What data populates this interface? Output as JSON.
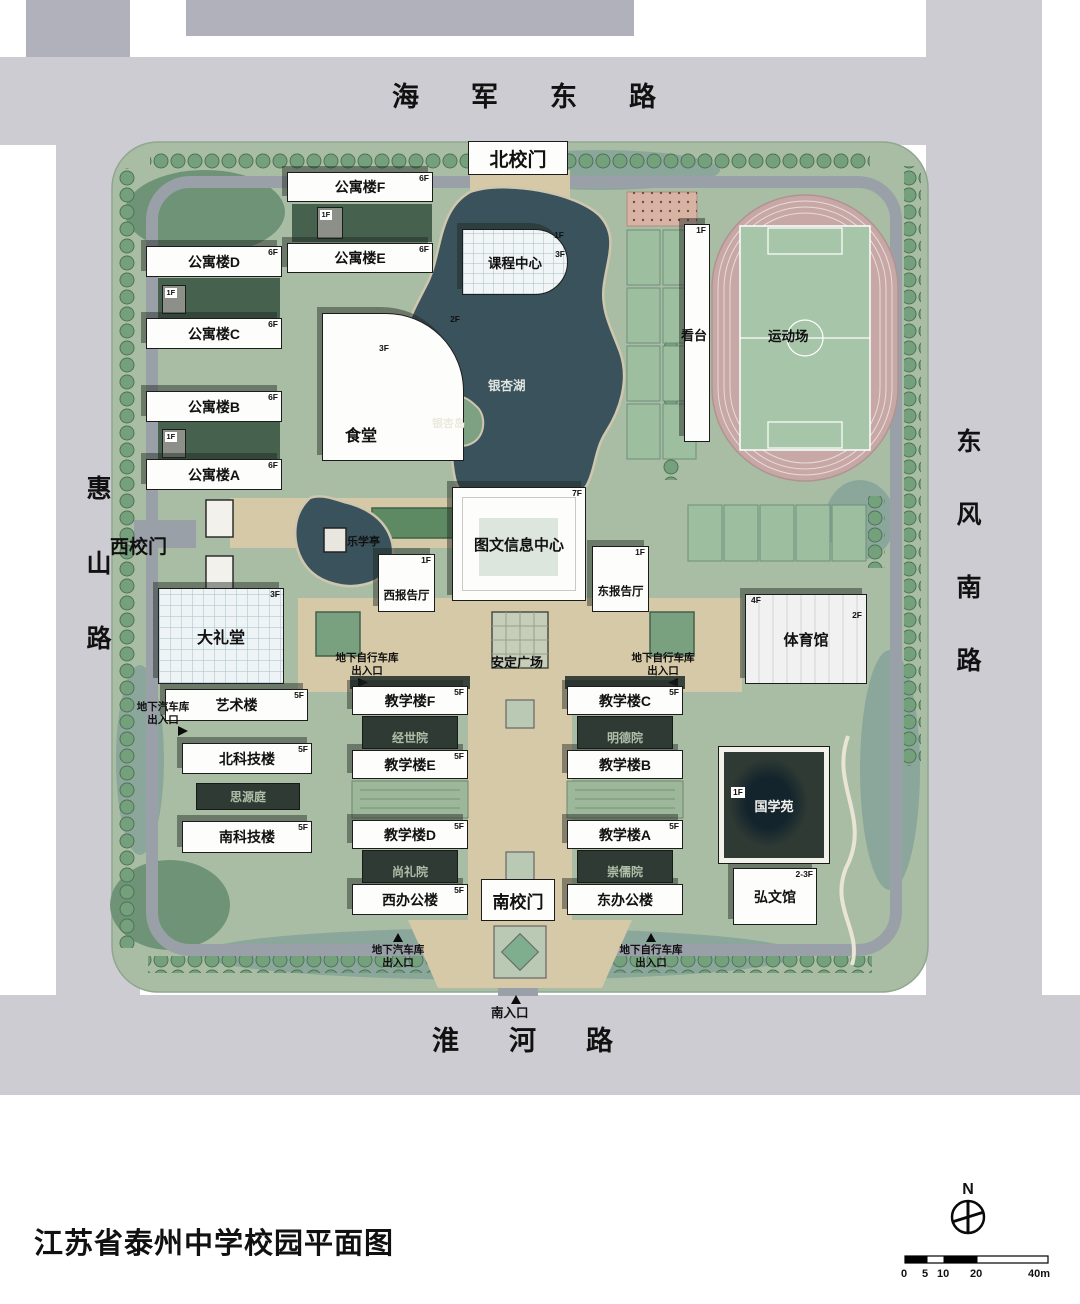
{
  "title": "江苏省泰州中学校园平面图",
  "roads": {
    "north": "海军东路",
    "west": "惠山路",
    "east": "东风南路",
    "south": "淮河路"
  },
  "gates": {
    "north": "北校门",
    "west": "西校门",
    "south": "南校门"
  },
  "landscape": {
    "lake": "银杏湖",
    "island": "银杏岛",
    "pavilion": "乐学亭",
    "plaza": "安定广场",
    "field": "运动场"
  },
  "underground": {
    "car": "地下汽车库",
    "bike": "地下自行车库",
    "entrance": "出入口",
    "south_entrance": "南入口"
  },
  "annex_floor": "1F",
  "buildings": [
    {
      "id": "apartment-f",
      "label": "公寓楼F",
      "floors": "6F"
    },
    {
      "id": "apartment-e",
      "label": "公寓楼E",
      "floors": "6F"
    },
    {
      "id": "apartment-d",
      "label": "公寓楼D",
      "floors": "6F"
    },
    {
      "id": "apartment-c",
      "label": "公寓楼C",
      "floors": "6F"
    },
    {
      "id": "apartment-b",
      "label": "公寓楼B",
      "floors": "6F"
    },
    {
      "id": "apartment-a",
      "label": "公寓楼A",
      "floors": "6F"
    },
    {
      "id": "canteen",
      "label": "食堂",
      "floors": "3F",
      "floors2": "2F"
    },
    {
      "id": "course-center",
      "label": "课程中心",
      "floors": "3F",
      "floors2": "1F"
    },
    {
      "id": "library",
      "label": "图文信息中心",
      "floors": "7F"
    },
    {
      "id": "west-lecture",
      "label": "西报告厅",
      "floors": "1F"
    },
    {
      "id": "east-lecture",
      "label": "东报告厅",
      "floors": "1F"
    },
    {
      "id": "auditorium",
      "label": "大礼堂",
      "floors": "3F"
    },
    {
      "id": "art",
      "label": "艺术楼",
      "floors": "5F"
    },
    {
      "id": "north-science",
      "label": "北科技楼",
      "floors": "5F"
    },
    {
      "id": "south-science",
      "label": "南科技楼",
      "floors": "5F"
    },
    {
      "id": "grandstand",
      "label": "看台",
      "floors": "1F"
    },
    {
      "id": "gym",
      "label": "体育馆",
      "floors": "4F",
      "floors2": "2F"
    },
    {
      "id": "teaching-f",
      "label": "教学楼F",
      "floors": "5F"
    },
    {
      "id": "teaching-e",
      "label": "教学楼E",
      "floors": "5F"
    },
    {
      "id": "teaching-d",
      "label": "教学楼D",
      "floors": "5F"
    },
    {
      "id": "teaching-c",
      "label": "教学楼C",
      "floors": "5F"
    },
    {
      "id": "teaching-b",
      "label": "教学楼B"
    },
    {
      "id": "teaching-a",
      "label": "教学楼A",
      "floors": "5F"
    },
    {
      "id": "west-office",
      "label": "西办公楼",
      "floors": "5F"
    },
    {
      "id": "east-office",
      "label": "东办公楼"
    },
    {
      "id": "hongwen",
      "label": "弘文馆",
      "floors": "2-3F"
    }
  ],
  "courtyards": [
    {
      "id": "jingshi",
      "label": "经世院"
    },
    {
      "id": "mingde",
      "label": "明德院"
    },
    {
      "id": "shangli",
      "label": "尚礼院"
    },
    {
      "id": "chongru",
      "label": "崇儒院"
    },
    {
      "id": "siyuan",
      "label": "思源庭"
    },
    {
      "id": "guoxue",
      "label": "国学苑",
      "floors": "1F"
    }
  ],
  "compass_n": "N",
  "scalebar": {
    "labels": [
      "0",
      "5",
      "10",
      "20",
      "40m"
    ]
  }
}
